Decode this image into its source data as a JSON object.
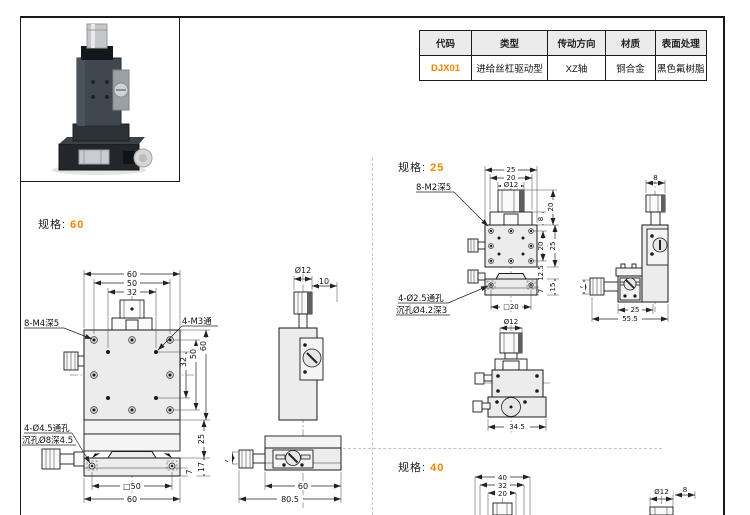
{
  "accent": "#f08300",
  "spec_table": {
    "headers": [
      "代码",
      "类型",
      "传动方向",
      "材质",
      "表面处理"
    ],
    "rows": [
      [
        "DJX01",
        "进给丝杠驱动型",
        "XZ轴",
        "铜合金",
        "黑色氟树脂"
      ]
    ]
  },
  "sections": {
    "spec60": {
      "label": "规格:",
      "value": "60"
    },
    "spec25": {
      "label": "规格:",
      "value": "25"
    },
    "spec40": {
      "label": "规格:",
      "value": "40"
    }
  },
  "drawings": {
    "s60_front": {
      "top": [
        "60",
        "50",
        "32"
      ],
      "right_upper": [
        "32",
        "50",
        "60"
      ],
      "right_lower": [
        "25",
        "17",
        "7"
      ],
      "bottom": [
        "□50",
        "60"
      ],
      "label_holes8": "8-M4深5",
      "label_holes4": "4-M3通",
      "label_through": "4-Ø4.5通孔",
      "label_cbore": "沉孔Ø8深4.5"
    },
    "s60_side": {
      "dia": "Ø12",
      "offset": "10",
      "width": "60",
      "total_width": "80.5",
      "height7": "7"
    },
    "s25_front": {
      "top": [
        "25",
        "20",
        "Ø12"
      ],
      "right_upper": [
        "20",
        "8"
      ],
      "right_mid": [
        "20",
        "25"
      ],
      "right_lower": [
        "12.5",
        "15",
        "7"
      ],
      "bottom": "□20",
      "label_holes8": "8-M2深5",
      "label_through": "4-Ø2.5通孔",
      "label_cbore": "沉孔Ø4.2深3"
    },
    "s25_front2": {
      "dia": "Ø12",
      "width": "34.5"
    },
    "s25_side": {
      "top": "8",
      "width": "25",
      "total_width": "55.5",
      "height7": "7"
    },
    "s40_front": {
      "top": [
        "40",
        "32",
        "20"
      ]
    },
    "s40_side": {
      "dia": "Ø12",
      "offset": "8"
    }
  }
}
